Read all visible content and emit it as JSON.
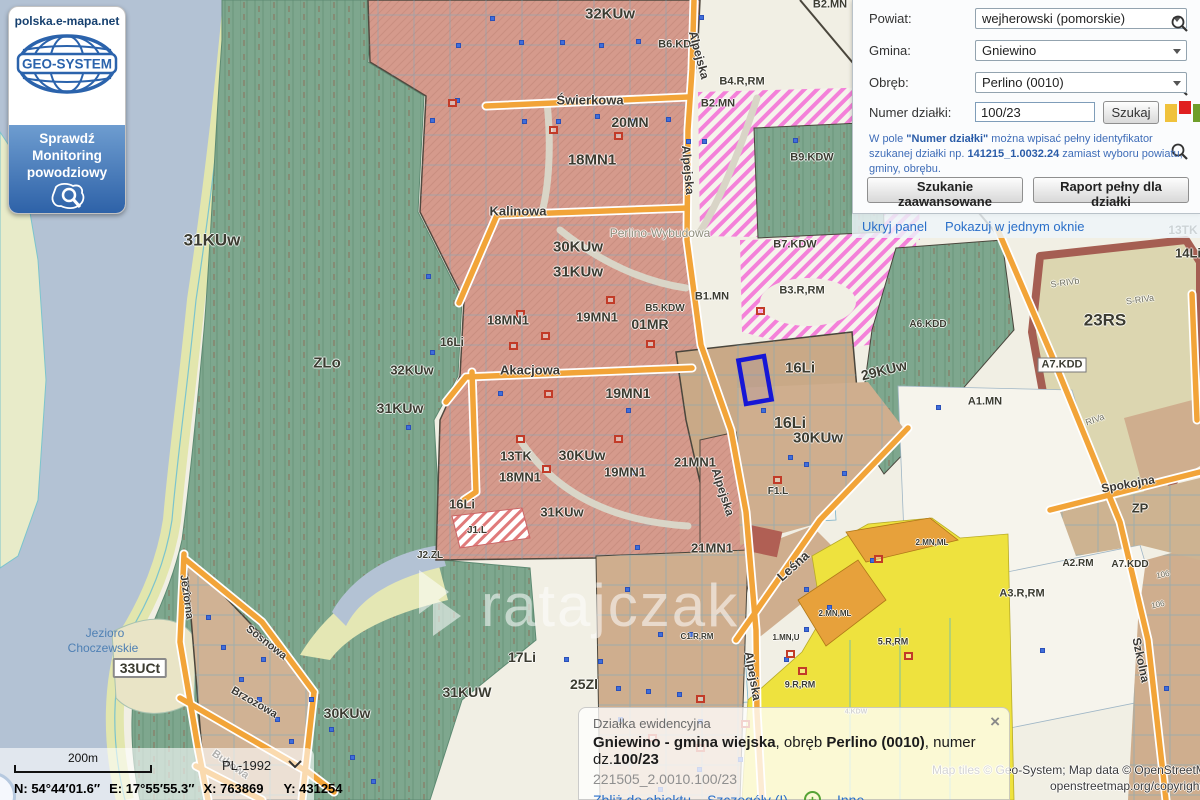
{
  "branding": {
    "site": "polska.e-mapa.net",
    "logo_text": "GEO-SYSTEM",
    "flood_line1": "Sprawdź",
    "flood_line2": "Monitoring",
    "flood_line3": "powodziowy"
  },
  "search_panel": {
    "rows": [
      {
        "label": "Powiat:",
        "value": "wejherowski (pomorskie)"
      },
      {
        "label": "Gmina:",
        "value": "Gniewino"
      },
      {
        "label": "Obręb:",
        "value": "Perlino (0010)"
      }
    ],
    "parcel_label": "Numer działki:",
    "parcel_value": "100/23",
    "search_button": "Szukaj",
    "hint": {
      "p1": "W pole ",
      "p2": "\"Numer działki\"",
      "p3": " można wpisać pełny identyfikator szukanej działki np. ",
      "p4": "141215_1.0032.24",
      "p5": " zamiast wyboru powiatu, gminy, obrębu."
    },
    "advanced_button": "Szukanie zaawansowane",
    "report_button": "Raport pełny dla działki",
    "hide_panel_link": "Ukryj panel",
    "single_window_link": "Pokazuj w jednym oknie"
  },
  "info_panel": {
    "title": "Działka ewidencyjna",
    "line": {
      "b1": "Gniewino - gmina wiejska",
      "t1": ", obręb ",
      "b2": "Perlino (0010)",
      "t2": ", numer dz.",
      "b3": "100/23"
    },
    "parcel_id": "221505_2.0010.100/23",
    "links": {
      "zoom_to": "Zbliż do obiektu",
      "details": "Szczegóły (I)",
      "other": "Inne"
    },
    "close": "×"
  },
  "status_bar": {
    "scale": "200m",
    "crs": "PL-1992",
    "n": "N: 54°44′01.6″",
    "e": "E: 17°55′55.3″",
    "x": "X: 763869",
    "y": "Y: 431254"
  },
  "attribution": {
    "line1": "Map tiles © Geo-System; Map data © OpenStreetMap",
    "line2": "openstreetmap.org/copyright"
  },
  "colors": {
    "accent_link": "#2a6fc9",
    "selected_parcel": "#1616d6",
    "street_orange": "#f2a438",
    "forest_green": "#7ea78e",
    "residential_salmon": "#d59a8c",
    "water_blue": "#b3c2d4",
    "zone_yellow": "#eee23e",
    "zone_magenta": "#f25ad2",
    "legend_yellow": "#f0c23c",
    "legend_red": "#e02020",
    "legend_green": "#6f9e2a"
  },
  "map": {
    "watermark": "ratajczak",
    "labels": [
      {
        "t": "32KUw",
        "x": 610,
        "y": 14,
        "s": 15
      },
      {
        "t": "B6.KDL",
        "x": 678,
        "y": 45,
        "s": 11
      },
      {
        "t": "20MN",
        "x": 630,
        "y": 122,
        "s": 14
      },
      {
        "t": "18MN1",
        "x": 592,
        "y": 160,
        "s": 15
      },
      {
        "t": "B2.MN",
        "x": 830,
        "y": 5,
        "s": 11
      },
      {
        "t": "B4.R,RM",
        "x": 742,
        "y": 82,
        "s": 11
      },
      {
        "t": "B2.MN",
        "x": 718,
        "y": 104,
        "s": 11
      },
      {
        "t": "B9.KDW",
        "x": 812,
        "y": 158,
        "s": 11
      },
      {
        "t": "B7.KDW",
        "x": 795,
        "y": 245,
        "s": 11
      },
      {
        "t": "B3.R,RM",
        "x": 802,
        "y": 291,
        "s": 11
      },
      {
        "t": "31KUw",
        "x": 212,
        "y": 240,
        "s": 17
      },
      {
        "t": "30KUw",
        "x": 578,
        "y": 247,
        "s": 15
      },
      {
        "t": "31KUw",
        "x": 578,
        "y": 272,
        "s": 15
      },
      {
        "t": "Perlino-Wybudowa",
        "x": 660,
        "y": 233,
        "s": 12,
        "c": "gr"
      },
      {
        "t": "ZLo",
        "x": 327,
        "y": 363,
        "s": 15
      },
      {
        "t": "18MN1",
        "x": 508,
        "y": 320,
        "s": 13
      },
      {
        "t": "19MN1",
        "x": 597,
        "y": 317,
        "s": 13
      },
      {
        "t": "B5.KDW",
        "x": 665,
        "y": 309,
        "s": 10
      },
      {
        "t": "01MR",
        "x": 650,
        "y": 324,
        "s": 14
      },
      {
        "t": "B1.MN",
        "x": 712,
        "y": 297,
        "s": 11
      },
      {
        "t": "16Li",
        "x": 452,
        "y": 342,
        "s": 12
      },
      {
        "t": "32KUw",
        "x": 412,
        "y": 370,
        "s": 13
      },
      {
        "t": "31KUw",
        "x": 400,
        "y": 408,
        "s": 14
      },
      {
        "t": "19MN1",
        "x": 628,
        "y": 393,
        "s": 14
      },
      {
        "t": "16Li",
        "x": 800,
        "y": 368,
        "s": 15
      },
      {
        "t": "29KUw",
        "x": 884,
        "y": 370,
        "s": 14,
        "r": -14
      },
      {
        "t": "16Li",
        "x": 790,
        "y": 424,
        "s": 16
      },
      {
        "t": "30KUw",
        "x": 818,
        "y": 438,
        "s": 15
      },
      {
        "t": "13TK",
        "x": 516,
        "y": 456,
        "s": 13
      },
      {
        "t": "30KUw",
        "x": 582,
        "y": 455,
        "s": 14
      },
      {
        "t": "18MN1",
        "x": 520,
        "y": 477,
        "s": 13
      },
      {
        "t": "19MN1",
        "x": 625,
        "y": 472,
        "s": 13
      },
      {
        "t": "21MN1",
        "x": 695,
        "y": 462,
        "s": 13
      },
      {
        "t": "31KUw",
        "x": 562,
        "y": 512,
        "s": 13
      },
      {
        "t": "16Li",
        "x": 462,
        "y": 504,
        "s": 13
      },
      {
        "t": "J1.L",
        "x": 477,
        "y": 531,
        "s": 10
      },
      {
        "t": "J2.ZL",
        "x": 430,
        "y": 556,
        "s": 10
      },
      {
        "t": "21MN1",
        "x": 712,
        "y": 548,
        "s": 13
      },
      {
        "t": "F1.L",
        "x": 778,
        "y": 492,
        "s": 10
      },
      {
        "t": "A6.KDD",
        "x": 928,
        "y": 325,
        "s": 10
      },
      {
        "t": "A1.MN",
        "x": 985,
        "y": 402,
        "s": 11
      },
      {
        "t": "A7.KDD",
        "x": 1062,
        "y": 365,
        "s": 11,
        "bx": 1
      },
      {
        "t": "23RS",
        "x": 1105,
        "y": 320,
        "s": 17
      },
      {
        "t": "14Li",
        "x": 1188,
        "y": 253,
        "s": 13
      },
      {
        "t": "13TK",
        "x": 1183,
        "y": 230,
        "s": 12
      },
      {
        "t": "ZP",
        "x": 1140,
        "y": 508,
        "s": 13
      },
      {
        "t": "A3.R,RM",
        "x": 1022,
        "y": 594,
        "s": 11
      },
      {
        "t": "A2.RM",
        "x": 1078,
        "y": 564,
        "s": 10
      },
      {
        "t": "A7.KDD",
        "x": 1130,
        "y": 565,
        "s": 10
      },
      {
        "t": "5.R,RM",
        "x": 893,
        "y": 642,
        "s": 9
      },
      {
        "t": "9.R,RM",
        "x": 800,
        "y": 685,
        "s": 9
      },
      {
        "t": "2.MN,ML",
        "x": 932,
        "y": 543,
        "s": 8
      },
      {
        "t": "2.MN,ML",
        "x": 835,
        "y": 614,
        "s": 8
      },
      {
        "t": "1.MN,U",
        "x": 786,
        "y": 638,
        "s": 8
      },
      {
        "t": "C1.R,RM",
        "x": 697,
        "y": 637,
        "s": 8
      },
      {
        "t": "4.KDW",
        "x": 856,
        "y": 712,
        "s": 7
      },
      {
        "t": "33UCt",
        "x": 140,
        "y": 668,
        "s": 14,
        "bx": 2
      },
      {
        "t": "17Li",
        "x": 522,
        "y": 657,
        "s": 14
      },
      {
        "t": "25Zl",
        "x": 584,
        "y": 684,
        "s": 14
      },
      {
        "t": "31KUW",
        "x": 467,
        "y": 692,
        "s": 14
      },
      {
        "t": "30KUw",
        "x": 347,
        "y": 713,
        "s": 14
      },
      {
        "t": "Świerkowa",
        "x": 590,
        "y": 100,
        "s": 13,
        "c": "st"
      },
      {
        "t": "Kalinowa",
        "x": 518,
        "y": 211,
        "s": 13,
        "c": "st"
      },
      {
        "t": "Akacjowa",
        "x": 530,
        "y": 370,
        "s": 13,
        "c": "st"
      },
      {
        "t": "Alpejska",
        "x": 699,
        "y": 55,
        "s": 12,
        "c": "st",
        "r": 75
      },
      {
        "t": "Alpejska",
        "x": 688,
        "y": 170,
        "s": 12,
        "c": "st",
        "r": 85
      },
      {
        "t": "Alpejska",
        "x": 723,
        "y": 492,
        "s": 12,
        "c": "st",
        "r": 72
      },
      {
        "t": "Alpejska",
        "x": 753,
        "y": 676,
        "s": 12,
        "c": "st",
        "r": 80
      },
      {
        "t": "Leśna",
        "x": 793,
        "y": 566,
        "s": 13,
        "c": "st",
        "r": -42
      },
      {
        "t": "Spokojna",
        "x": 1128,
        "y": 484,
        "s": 12,
        "c": "st",
        "r": -10
      },
      {
        "t": "Szkolna",
        "x": 1141,
        "y": 660,
        "s": 12,
        "c": "st",
        "r": 78
      },
      {
        "t": "Jeziorna",
        "x": 186,
        "y": 597,
        "s": 11,
        "c": "st",
        "r": 82
      },
      {
        "t": "Sosnowa",
        "x": 266,
        "y": 643,
        "s": 11,
        "c": "st",
        "r": 38
      },
      {
        "t": "Brzozowa",
        "x": 254,
        "y": 703,
        "s": 11,
        "c": "st",
        "r": 30
      },
      {
        "t": "Bukowa",
        "x": 230,
        "y": 765,
        "s": 11,
        "c": "st",
        "r": 35
      },
      {
        "t": "Jezioro",
        "x": 105,
        "y": 633,
        "s": 12,
        "c": "wa"
      },
      {
        "t": "Choczewskie",
        "x": 103,
        "y": 648,
        "s": 12,
        "c": "wa"
      },
      {
        "t": "S-RIVa",
        "x": 1140,
        "y": 300,
        "s": 9,
        "c": "so",
        "r": -8
      },
      {
        "t": "S-RIVb",
        "x": 1065,
        "y": 283,
        "s": 9,
        "c": "so",
        "r": -8
      },
      {
        "t": "RIVa",
        "x": 1095,
        "y": 420,
        "s": 9,
        "c": "so",
        "r": -20
      },
      {
        "t": "106",
        "x": 1163,
        "y": 575,
        "s": 8,
        "c": "so",
        "r": -12
      },
      {
        "t": "106",
        "x": 1158,
        "y": 605,
        "s": 8,
        "c": "so",
        "r": -12
      }
    ],
    "address_points": [
      [
        432,
        120
      ],
      [
        457,
        100
      ],
      [
        458,
        45
      ],
      [
        492,
        18
      ],
      [
        521,
        42
      ],
      [
        524,
        121
      ],
      [
        558,
        121
      ],
      [
        562,
        42
      ],
      [
        597,
        116
      ],
      [
        601,
        45
      ],
      [
        633,
        121
      ],
      [
        638,
        41
      ],
      [
        668,
        119
      ],
      [
        701,
        17
      ],
      [
        704,
        141
      ],
      [
        688,
        141
      ],
      [
        795,
        140
      ],
      [
        905,
        86
      ],
      [
        921,
        8
      ],
      [
        934,
        47
      ],
      [
        428,
        276
      ],
      [
        432,
        352
      ],
      [
        408,
        427
      ],
      [
        500,
        393
      ],
      [
        628,
        410
      ],
      [
        633,
        472
      ],
      [
        637,
        547
      ],
      [
        627,
        589
      ],
      [
        566,
        659
      ],
      [
        600,
        661
      ],
      [
        660,
        634
      ],
      [
        690,
        634
      ],
      [
        763,
        410
      ],
      [
        790,
        457
      ],
      [
        806,
        464
      ],
      [
        830,
        437
      ],
      [
        806,
        589
      ],
      [
        829,
        607
      ],
      [
        806,
        629
      ],
      [
        786,
        659
      ],
      [
        618,
        688
      ],
      [
        648,
        691
      ],
      [
        679,
        694
      ],
      [
        620,
        719
      ],
      [
        700,
        721
      ],
      [
        740,
        759
      ],
      [
        699,
        769
      ],
      [
        660,
        789
      ],
      [
        208,
        617
      ],
      [
        223,
        647
      ],
      [
        241,
        679
      ],
      [
        259,
        699
      ],
      [
        277,
        719
      ],
      [
        291,
        741
      ],
      [
        263,
        659
      ],
      [
        311,
        699
      ],
      [
        331,
        729
      ],
      [
        352,
        757
      ],
      [
        373,
        781
      ],
      [
        938,
        407
      ],
      [
        1042,
        650
      ],
      [
        1166,
        688
      ],
      [
        844,
        473
      ],
      [
        872,
        560
      ]
    ],
    "buildings": [
      [
        452,
        103
      ],
      [
        553,
        130
      ],
      [
        618,
        136
      ],
      [
        520,
        314
      ],
      [
        545,
        336
      ],
      [
        513,
        346
      ],
      [
        548,
        394
      ],
      [
        610,
        300
      ],
      [
        650,
        344
      ],
      [
        618,
        439
      ],
      [
        520,
        439
      ],
      [
        546,
        469
      ],
      [
        760,
        311
      ],
      [
        777,
        480
      ],
      [
        700,
        699
      ],
      [
        745,
        724
      ],
      [
        790,
        654
      ],
      [
        802,
        671
      ],
      [
        878,
        559
      ],
      [
        908,
        656
      ],
      [
        652,
        738
      ],
      [
        700,
        748
      ]
    ]
  }
}
